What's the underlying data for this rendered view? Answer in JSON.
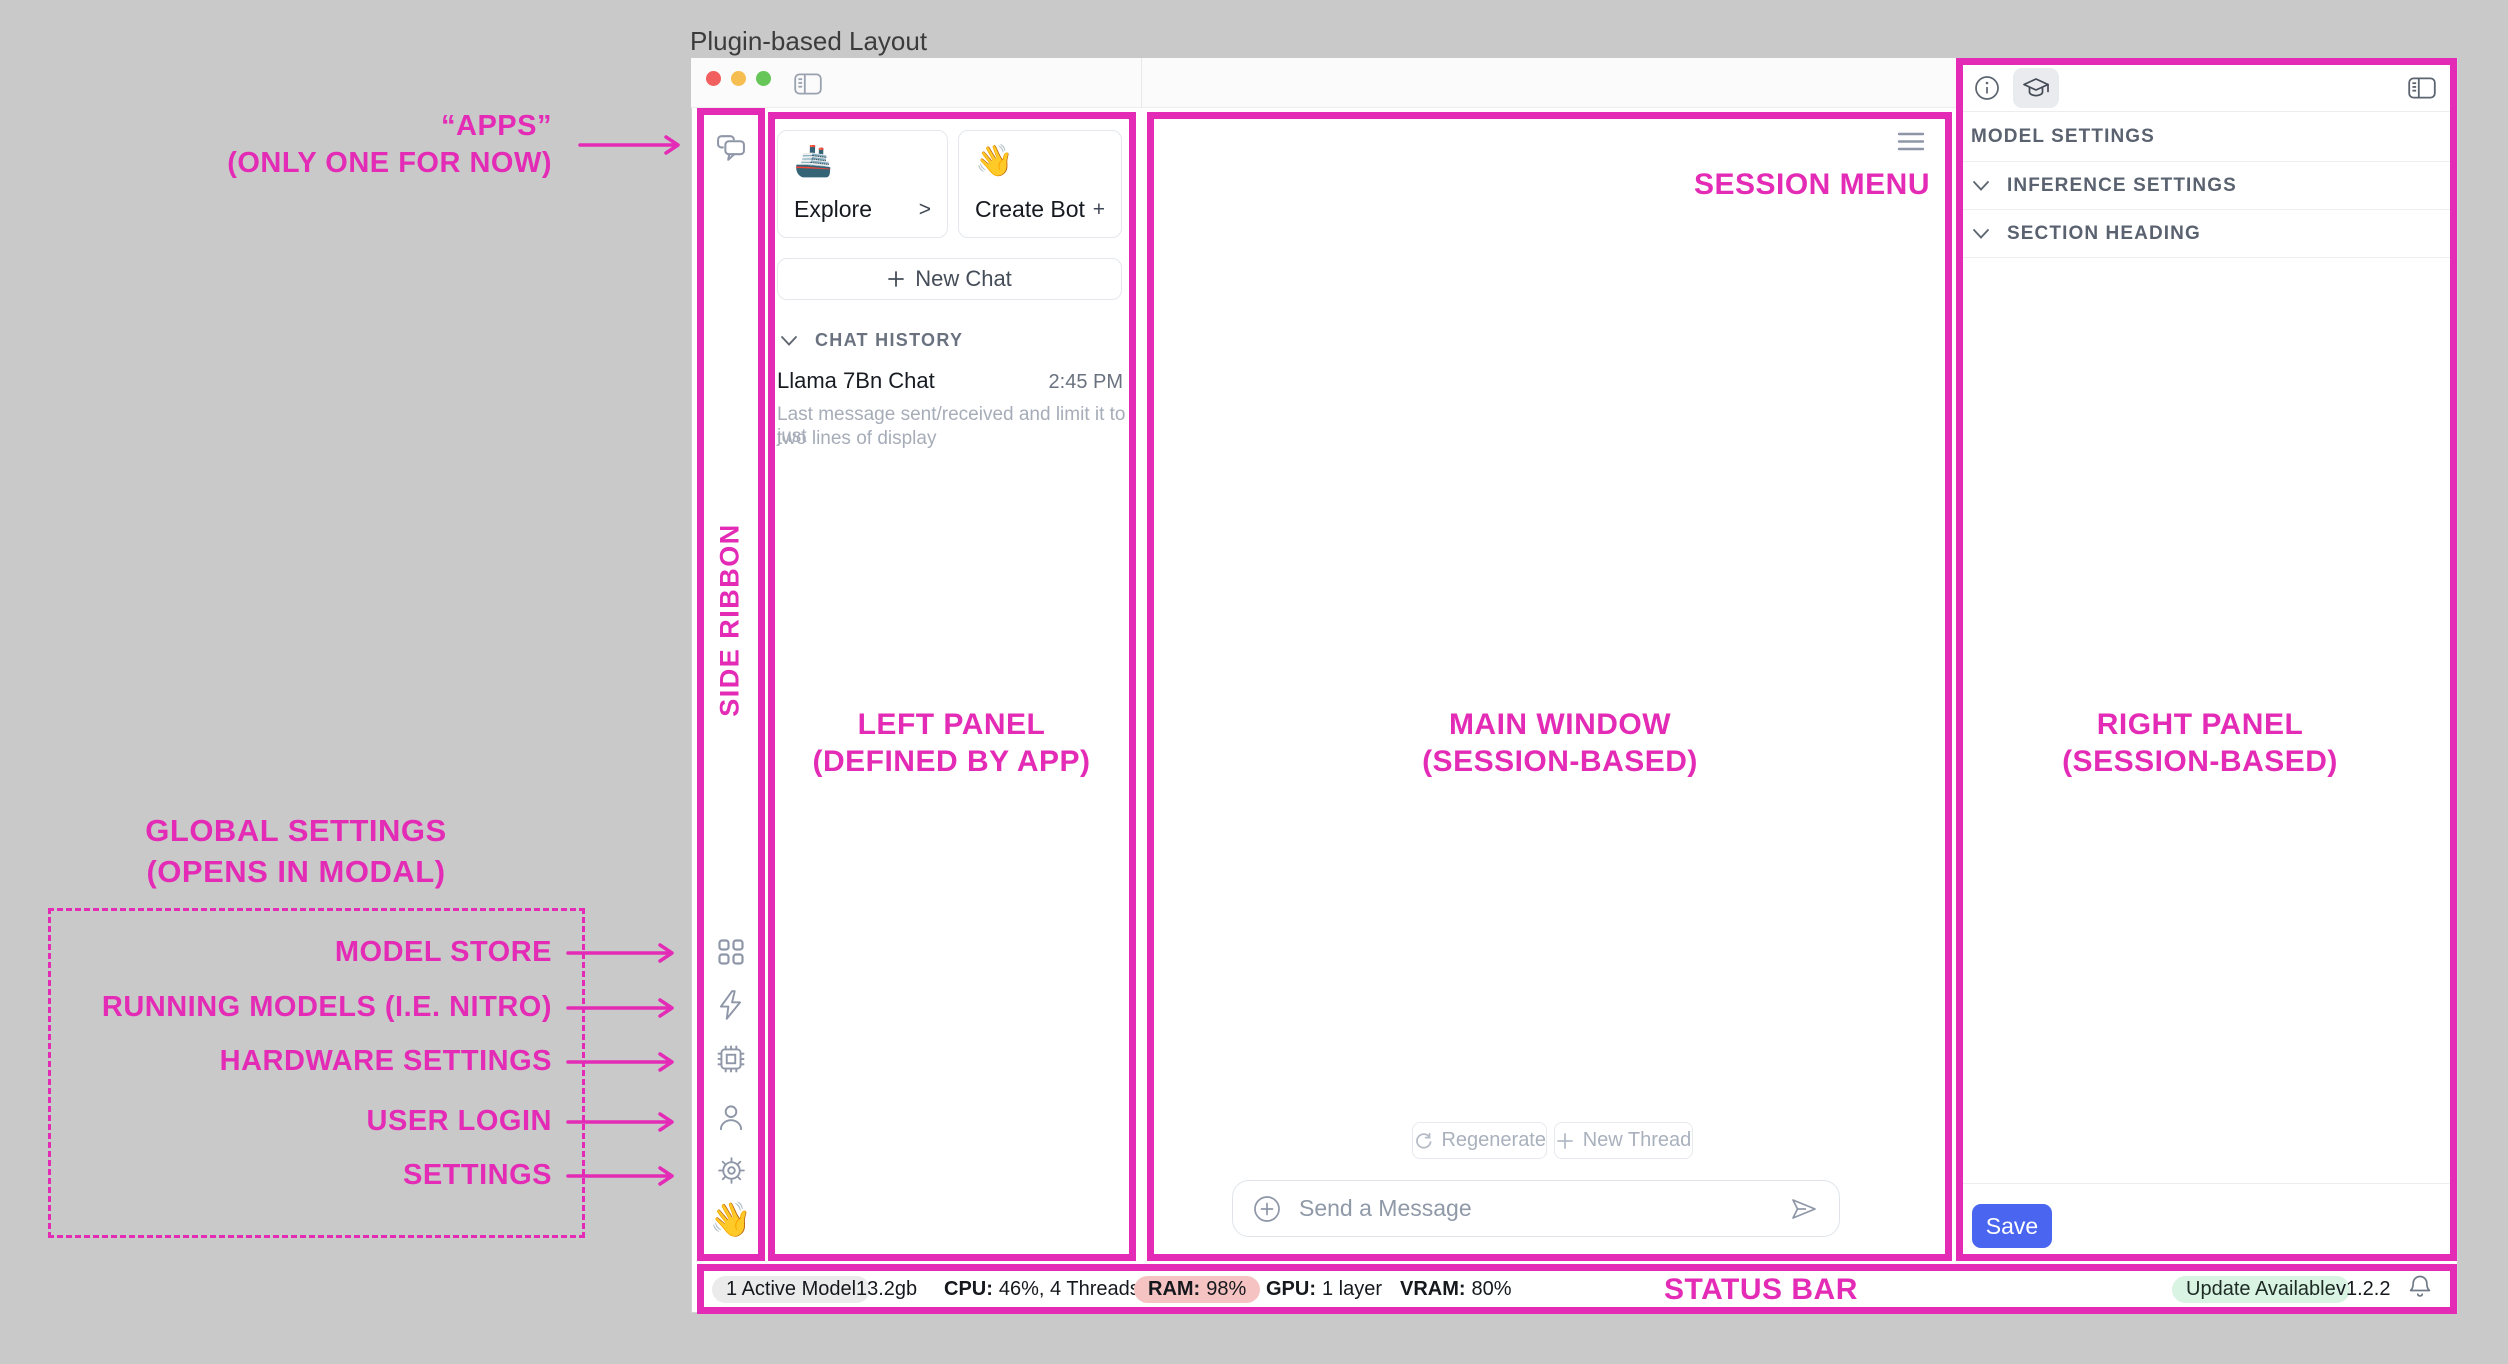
{
  "page": {
    "title": "Plugin-based Layout"
  },
  "colors": {
    "annotation_pink": "#e32bb6",
    "save_button_blue": "#4a66f0",
    "ram_pill_bg": "#f5c3c1",
    "update_pill_bg": "#d9f4e3",
    "traffic_red": "#f1605f",
    "traffic_yellow": "#f6be50",
    "traffic_green": "#66c658"
  },
  "annotations": {
    "apps_line1": "“APPS”",
    "apps_line2": "(ONLY ONE FOR NOW)",
    "side_ribbon": "SIDE RIBBON",
    "left_panel_line1": "LEFT PANEL",
    "left_panel_line2": "(DEFINED BY APP)",
    "main_window_line1": "MAIN WINDOW",
    "main_window_line2": "(SESSION-BASED)",
    "right_panel_line1": "RIGHT PANEL",
    "right_panel_line2": "(SESSION-BASED)",
    "session_menu": "SESSION MENU",
    "status_bar": "STATUS BAR",
    "global_line1": "GLOBAL SETTINGS",
    "global_line2": "(OPENS IN MODAL)",
    "ribbon_labels": [
      "MODEL STORE",
      "RUNNING MODELS (I.E. NITRO)",
      "HARDWARE SETTINGS",
      "USER LOGIN",
      "SETTINGS"
    ]
  },
  "left_panel": {
    "explore": {
      "emoji": "🚢",
      "label": "Explore",
      "affix": ">"
    },
    "create_bot": {
      "emoji": "👋",
      "label": "Create Bot",
      "affix": "+"
    },
    "new_chat_label": "New Chat",
    "chat_history_header": "CHAT HISTORY",
    "chat": {
      "title": "Llama 7Bn Chat",
      "time": "2:45 PM",
      "desc_line1": "Last message sent/received and limit it to just",
      "desc_line2": "two lines of display"
    }
  },
  "ribbon": {
    "wave_emoji": "👋"
  },
  "main": {
    "regenerate_label": "Regenerate",
    "new_thread_label": "New Thread",
    "input_placeholder": "Send a Message"
  },
  "right_panel": {
    "model_settings": "MODEL SETTINGS",
    "inference_settings": "INFERENCE SETTINGS",
    "section_heading": "SECTION HEADING",
    "save_label": "Save"
  },
  "status": {
    "active_model": "1 Active Model",
    "size": "13.2gb",
    "cpu_label": "CPU:",
    "cpu_value": "46%, 4 Threads",
    "ram_label": "RAM:",
    "ram_value": "98%",
    "gpu_label": "GPU:",
    "gpu_value": "1 layer",
    "vram_label": "VRAM:",
    "vram_value": "80%",
    "update_badge": "Update Available",
    "version": "v1.2.2"
  }
}
